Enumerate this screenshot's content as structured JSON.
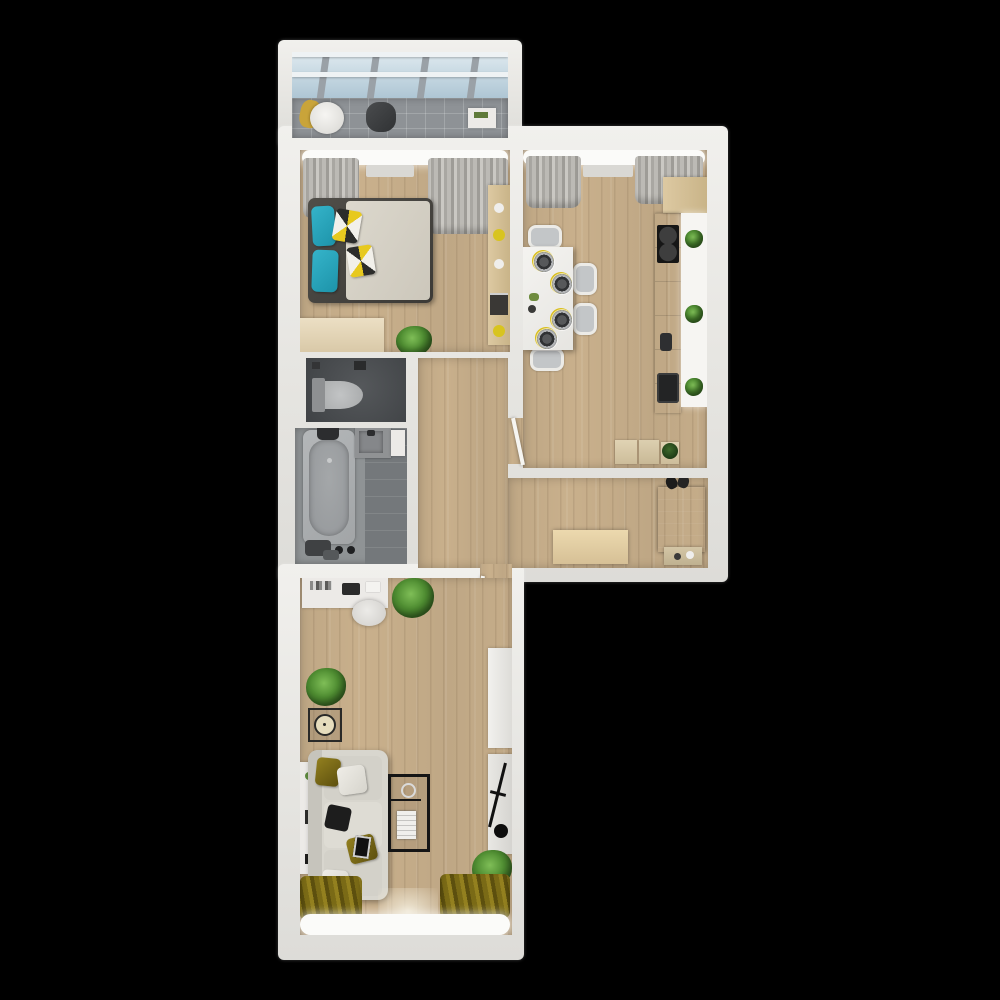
{
  "scene": {
    "type": "3d-floor-plan-top-view",
    "description": "Top-down 3D architectural render of a two-room apartment on a black background",
    "background_color": "#000000",
    "room_count": 7
  },
  "palette": {
    "wall_white": "#e8e7e3",
    "floor_wood": "#c9b08c",
    "balcony_tile": "#8e9296",
    "balcony_glass": "#b9cfdc",
    "bathroom_gray": "#8f9395",
    "wc_dark_gray": "#4b4e51",
    "accent_teal": "#28a7bd",
    "accent_yellow": "#d9be1c",
    "accent_olive": "#7a6a16",
    "plant_green": "#4e8c31",
    "dark_furniture": "#232120",
    "white_furniture": "#eceae7"
  },
  "rooms": {
    "balcony": {
      "name": "Balcony",
      "items": [
        "glazed slanted roof",
        "gray tiled floor",
        "round lounge chair",
        "yellow plaid",
        "dark storage bag",
        "small side table"
      ]
    },
    "bedroom": {
      "name": "Bedroom",
      "items": [
        "double bed",
        "2 teal pillows",
        "2 patterned pillows",
        "beige duvet",
        "gray curtains",
        "window pelmet",
        "dresser",
        "potted plant",
        "wall shelf with decor"
      ]
    },
    "kitchen": {
      "name": "Kitchen",
      "items": [
        "white dining table",
        "4 chairs",
        "4 place settings",
        "counter with cooktop and sink",
        "upper cabinet",
        "3 counter plants",
        "3 floor cushions",
        "plant on cushion",
        "gray curtains",
        "interior door"
      ]
    },
    "wc": {
      "name": "WC",
      "items": [
        "toilet"
      ]
    },
    "bathroom": {
      "name": "Bathroom",
      "items": [
        "bathtub",
        "wash basin",
        "towels",
        "tiled floor"
      ]
    },
    "hallway": {
      "name": "Hallway",
      "items": [
        "shoe cabinet",
        "dark wardrobe",
        "pair of shoes",
        "console table",
        "door to living room"
      ]
    },
    "living_room": {
      "name": "Living room",
      "items": [
        "desk with books and laptop",
        "desk chair",
        "L-shaped sofa",
        "olive pillows",
        "black pillow",
        "tablet",
        "black frame coffee table with magazines",
        "wire side table with clock",
        "wall console",
        "2 tv consoles",
        "leaning easel",
        "2 potted plants",
        "olive curtains",
        "window pelmet"
      ]
    }
  },
  "counts": {
    "dining_chairs": 4,
    "place_settings": 4,
    "plants_total": 8,
    "doors_visible": 2,
    "windows_with_curtains": 3
  }
}
